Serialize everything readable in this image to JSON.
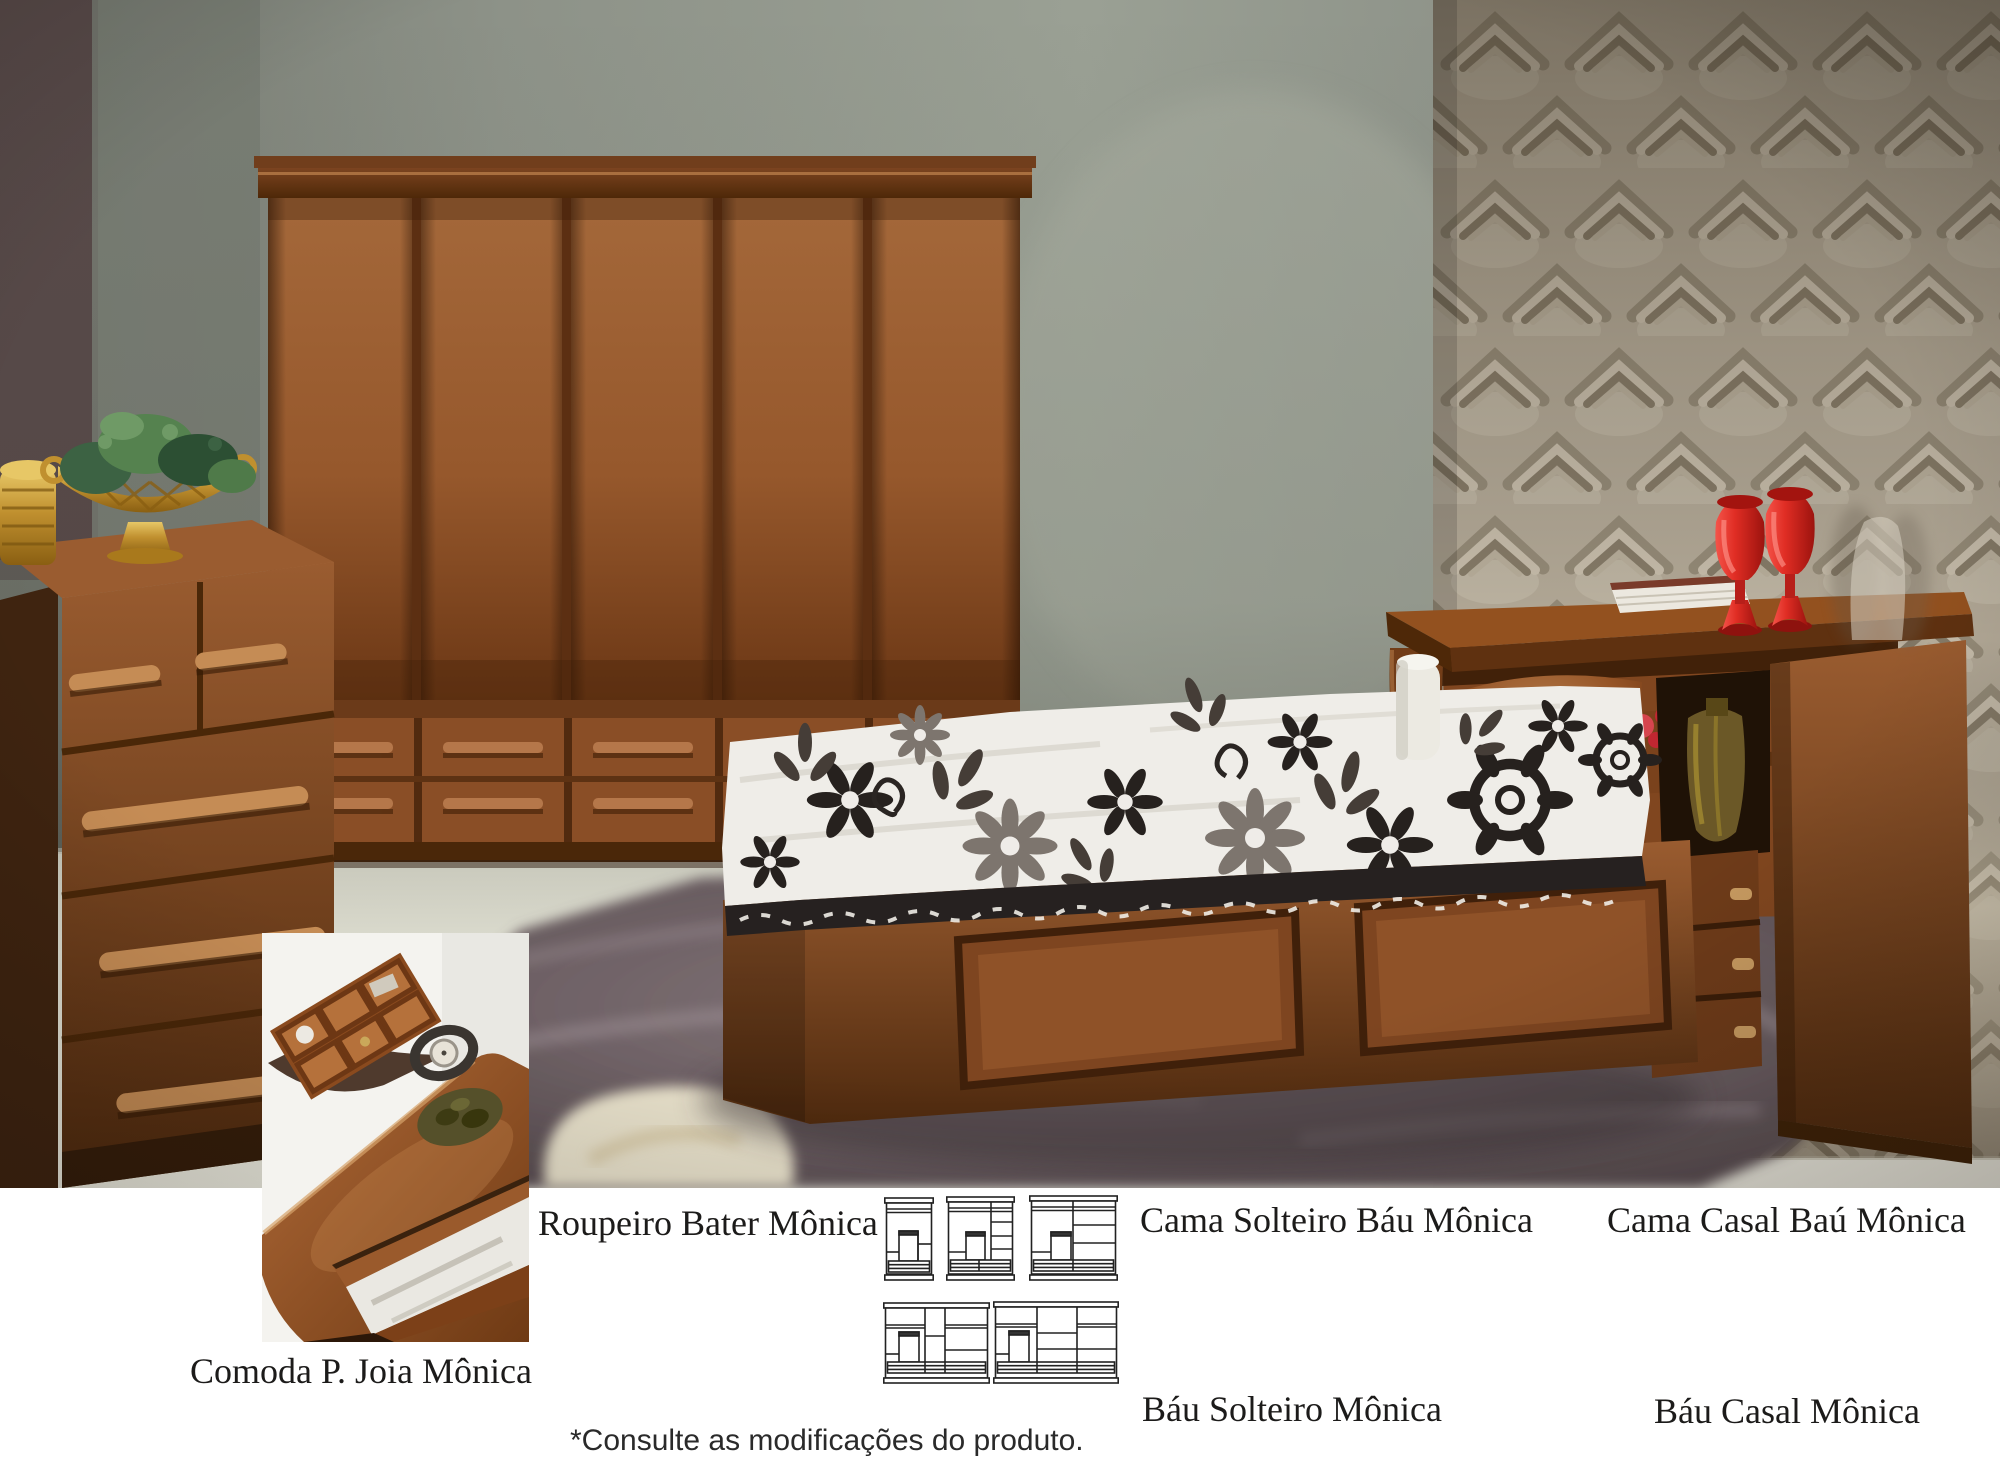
{
  "captions": {
    "roupeiro": "Roupeiro Bater Mônica",
    "cama_solteiro": "Cama Solteiro Báu Mônica",
    "cama_casal": "Cama Casal Baú Mônica",
    "bau_solteiro": "Báu Solteiro Mônica",
    "bau_casal": "Báu Casal Mônica",
    "comoda": "Comoda P. Joia Mônica",
    "note": "*Consulte as modificações do produto."
  },
  "diagrams": {
    "count": 5,
    "icon": "wardrobe-front-schematic"
  },
  "colors": {
    "page_bg": "#ffffff",
    "wood_mid": "#9a5c30",
    "wood_dark": "#5d3414",
    "wall_gray": "#8d9189",
    "wall_dark_corner": "#584a49",
    "wallpaper_beige": "#b2a896",
    "rug_gray_purple": "#6b5e62",
    "fur_cream": "#e8e1cb",
    "accent_red": "#e33128",
    "gold": "#c0902f",
    "quilt_white": "#efede8",
    "text": "#1c1b1a"
  }
}
